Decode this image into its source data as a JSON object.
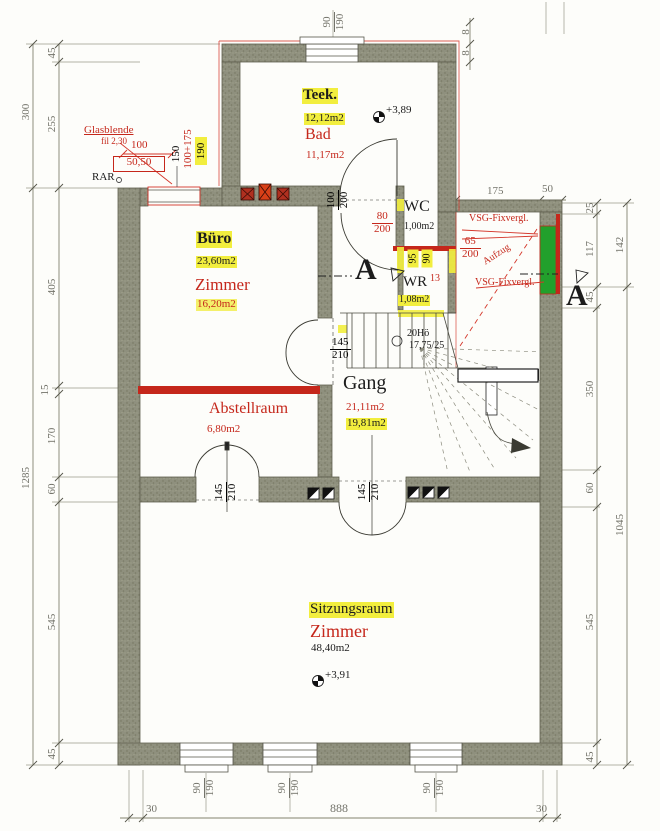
{
  "colors": {
    "wall": "#8f907e",
    "red": "#c5271b",
    "yellow": "#f2ee3e",
    "green": "#22a02c",
    "dim_text": "#73736a"
  },
  "rooms": {
    "teek": {
      "name": "Teek.",
      "area": "12,12m2",
      "alt_name": "Bad",
      "alt_area": "11,17m2",
      "level": "+3,89"
    },
    "buero": {
      "name": "Büro",
      "area": "23,60m2",
      "alt_name": "Zimmer",
      "alt_area": "16,20m2"
    },
    "abstellraum": {
      "name": "Abstellraum",
      "area": "6,80m2"
    },
    "gang": {
      "name": "Gang",
      "area": "21,11m2",
      "alt_area": "19,81m2"
    },
    "wc": {
      "name": "WC",
      "area": "1,00m2"
    },
    "wr": {
      "name": "WR",
      "area": "1,08m2"
    },
    "sitzungsraum": {
      "name": "Sitzungsraum",
      "alt_name": "Zimmer",
      "area": "48,40m2",
      "level": "+3,91"
    }
  },
  "stair": {
    "steps": "20Hö",
    "ratio": "17,75/25"
  },
  "annotations": {
    "glasblende": "Glasblende",
    "fil": "fil 2,30",
    "rar": "RAR",
    "dim_100": "100",
    "dim_5050": "50,50",
    "dim_150": "150",
    "dim_100_175": "100+175",
    "dim_190": "190",
    "vsg_top": "VSG-Fixvergl.",
    "vsg_bottom": "VSG-Fixvergl.",
    "aufzug": "Aufzug",
    "num_95": "95",
    "num_90": "90",
    "num_13": "13",
    "section_left": "A",
    "section_right": "A"
  },
  "doors": {
    "bad": {
      "w": "100",
      "h": "200"
    },
    "wc": {
      "w": "80",
      "h": "200"
    },
    "aufzug": {
      "w": "65",
      "h": "200"
    },
    "buero": {
      "w": "145",
      "h": "210"
    },
    "abstellraum": {
      "w": "145",
      "h": "210"
    },
    "sitzungsraum": {
      "w": "145",
      "h": "210"
    }
  },
  "windows": {
    "top": {
      "w": "90",
      "h": "190"
    },
    "bottom1": {
      "w": "90",
      "h": "190"
    },
    "bottom2": {
      "w": "90",
      "h": "190"
    },
    "bottom3": {
      "w": "90",
      "h": "190"
    }
  },
  "dims": {
    "top_right": [
      "8",
      "8"
    ],
    "wc_top": [
      "175",
      "50"
    ],
    "left_outer": [
      "300",
      "1285"
    ],
    "left_chain": [
      "45",
      "255",
      "405",
      "15",
      "170",
      "60",
      "545",
      "45"
    ],
    "right_chain": [
      "25",
      "117",
      "45",
      "350",
      "60",
      "545",
      "45"
    ],
    "right_outer": [
      "142",
      "1045"
    ],
    "bottom": [
      "30",
      "888",
      "30"
    ]
  }
}
